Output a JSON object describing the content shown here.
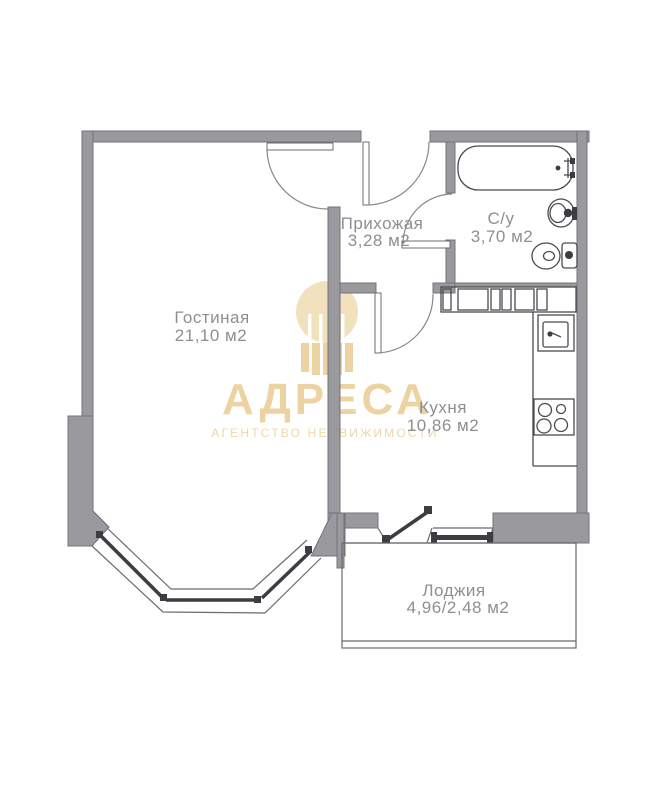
{
  "plan": {
    "rooms": [
      {
        "id": "living",
        "name": "Гостиная",
        "area": "21,10 м2"
      },
      {
        "id": "hallway",
        "name": "Прихожая",
        "area": "3,28 м2"
      },
      {
        "id": "bathroom",
        "name": "С/у",
        "area": "3,70 м2"
      },
      {
        "id": "kitchen",
        "name": "Кухня",
        "area": "10,86 м2"
      },
      {
        "id": "loggia",
        "name": "Лоджия",
        "area": "4,96/2,48 м2"
      }
    ]
  },
  "watermark": {
    "brand": "АДРЕСА",
    "tagline": "АГЕНТСТВО НЕДВИЖИМОСТИ"
  },
  "colors": {
    "wall": "#9a9a9e",
    "label": "#8f8f93",
    "gold": "#e9c98c",
    "gold_light": "#f0dcb2",
    "background": "#ffffff"
  }
}
